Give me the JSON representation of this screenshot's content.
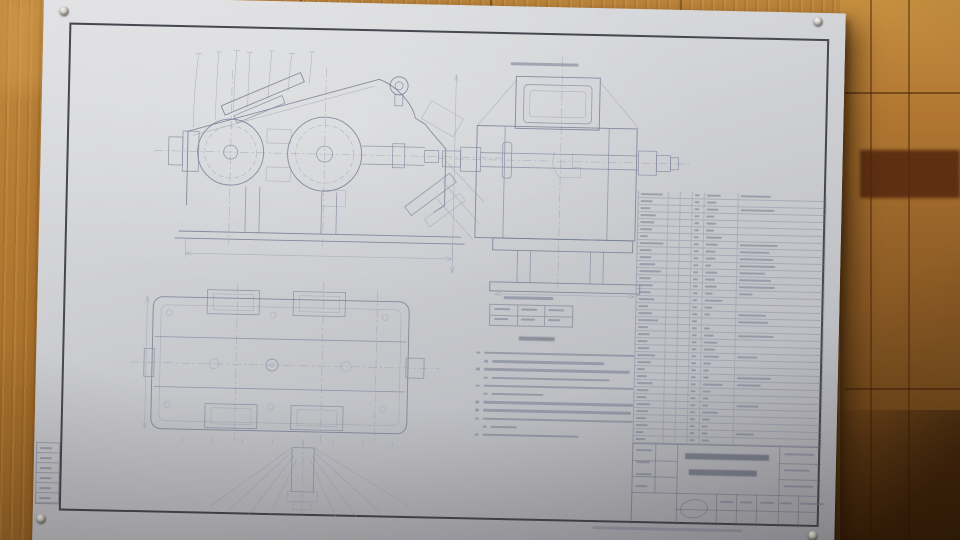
{
  "scene": {
    "subject": "photo of a mechanical gear-reducer assembly drawing sheet pinned to a wooden floor",
    "legible_text": false
  },
  "colors": {
    "wood_base": "#b67c33",
    "wood_light": "#d89f4e",
    "wood_dark": "#5a370f",
    "paper": "#cfd0d4",
    "ink": "#848aa0",
    "frame": "#46474f"
  },
  "parts_table": {
    "row_count": 36,
    "column_count": 6,
    "rows": [
      [
        22,
        5,
        14,
        30
      ],
      [
        12,
        5,
        10,
        0
      ],
      [
        10,
        5,
        12,
        34
      ],
      [
        16,
        5,
        8,
        0
      ],
      [
        14,
        5,
        10,
        0
      ],
      [
        12,
        5,
        8,
        0
      ],
      [
        8,
        5,
        16,
        0
      ],
      [
        24,
        5,
        12,
        38
      ],
      [
        12,
        5,
        10,
        30
      ],
      [
        12,
        5,
        10,
        34
      ],
      [
        16,
        5,
        6,
        36
      ],
      [
        22,
        5,
        12,
        26
      ],
      [
        12,
        5,
        10,
        32
      ],
      [
        14,
        5,
        12,
        36
      ],
      [
        12,
        5,
        8,
        14
      ],
      [
        16,
        5,
        18,
        0
      ],
      [
        10,
        5,
        8,
        0
      ],
      [
        14,
        5,
        6,
        28
      ],
      [
        20,
        5,
        0,
        30
      ],
      [
        10,
        5,
        6,
        0
      ],
      [
        12,
        5,
        10,
        36
      ],
      [
        10,
        5,
        14,
        0
      ],
      [
        12,
        5,
        12,
        0
      ],
      [
        18,
        5,
        16,
        20
      ],
      [
        14,
        5,
        8,
        0
      ],
      [
        8,
        5,
        6,
        0
      ],
      [
        10,
        5,
        6,
        34
      ],
      [
        16,
        5,
        20,
        24
      ],
      [
        12,
        5,
        8,
        0
      ],
      [
        10,
        5,
        6,
        0
      ],
      [
        14,
        5,
        6,
        22
      ],
      [
        12,
        5,
        16,
        0
      ],
      [
        10,
        5,
        8,
        0
      ],
      [
        12,
        5,
        6,
        0
      ],
      [
        8,
        5,
        6,
        18
      ],
      [
        10,
        5,
        8,
        0
      ]
    ]
  },
  "notes": {
    "heading_w": 36,
    "lines": [
      {
        "w": 150,
        "i": 0
      },
      {
        "w": 112,
        "i": 8
      },
      {
        "w": 146,
        "i": 0
      },
      {
        "w": 118,
        "i": 8
      },
      {
        "w": 150,
        "i": 0
      },
      {
        "w": 52,
        "i": 8
      },
      {
        "w": 150,
        "i": 0
      },
      {
        "w": 148,
        "i": 0
      },
      {
        "w": 150,
        "i": 0
      },
      {
        "w": 26,
        "i": 8
      },
      {
        "w": 96,
        "i": 0
      }
    ]
  },
  "char_table": {
    "rows": 2,
    "cols": 3,
    "title_w": 50,
    "cell_w": 16
  },
  "side_view_label_w": 68,
  "margin_table": {
    "row_count": 6,
    "cell_text_w": 12
  },
  "title_block": {
    "title_row1_w": 84,
    "title_row2_w": 68,
    "right_cell_ws": [
      30,
      26,
      30
    ],
    "sig_row_ws": [
      16,
      14,
      16,
      12
    ],
    "bottom_row_ws": [
      14,
      12,
      14,
      12,
      24
    ]
  },
  "imprint": {
    "w": 150
  }
}
